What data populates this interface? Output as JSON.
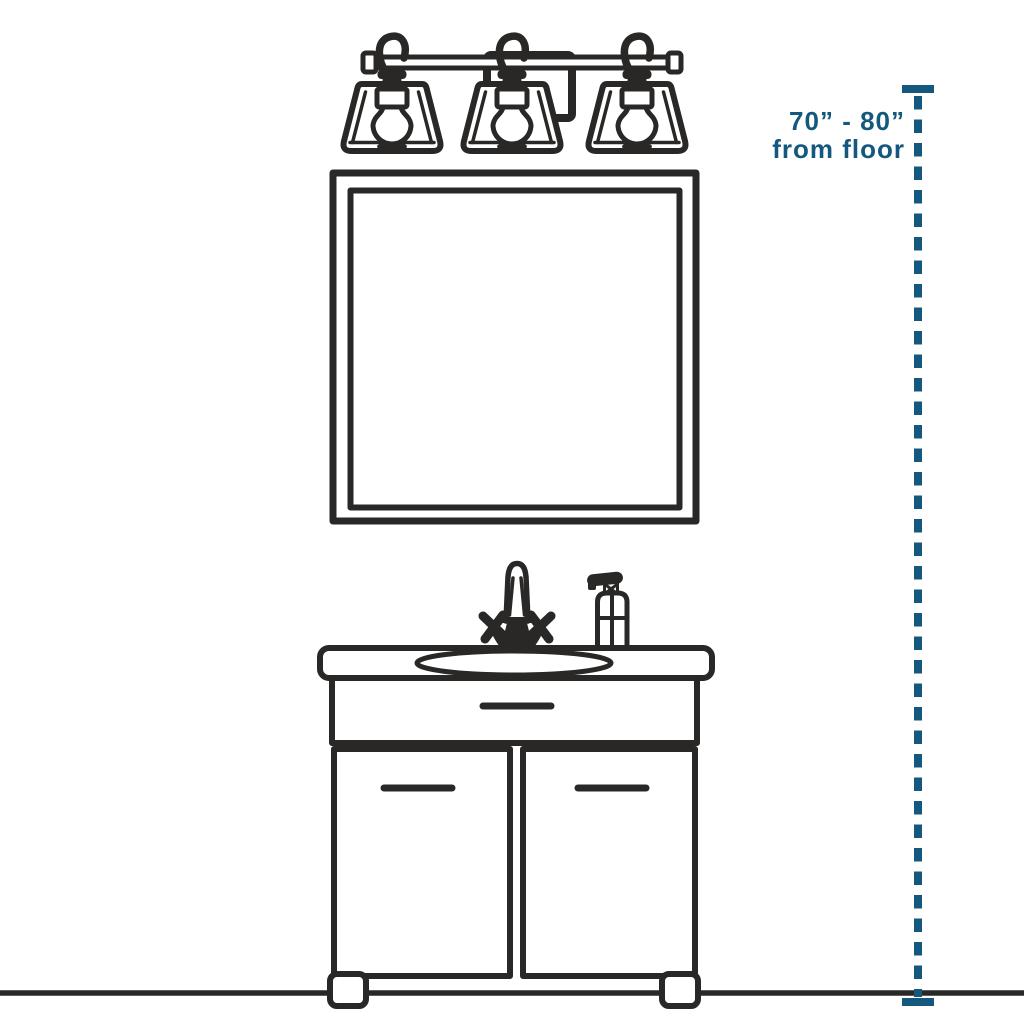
{
  "colors": {
    "ink": "#2A2826",
    "accent": "#14587E",
    "bg": "#FFFFFF"
  },
  "dimension_annotation": {
    "line1": "70” - 80”",
    "line2": "from floor"
  },
  "icons": [
    "three-light-vanity-fixture-icon",
    "wall-mirror-icon",
    "bathroom-vanity-cabinet-icon",
    "sink-basin-icon",
    "faucet-icon",
    "soap-dispenser-icon",
    "floor-line",
    "height-dimension-line"
  ]
}
